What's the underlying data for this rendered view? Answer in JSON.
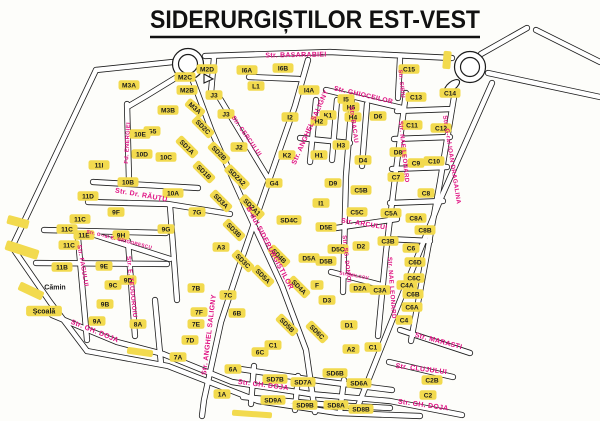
{
  "title": "SIDERURGIȘTILOR EST-VEST",
  "map": {
    "colors": {
      "background": "#fdfdfa",
      "road_line": "#1c1c1c",
      "road_fill": "#ffffff",
      "block_fill": "#f2da4e",
      "block_text": "#1a1a1a",
      "street_text": "#e01283"
    },
    "blocks": [
      {
        "label": "M3A",
        "x": 129,
        "y": 85
      },
      {
        "label": "M2D",
        "x": 207,
        "y": 69
      },
      {
        "label": "M2C",
        "x": 185,
        "y": 77
      },
      {
        "label": "M2B",
        "x": 187,
        "y": 90
      },
      {
        "label": "M3A",
        "x": 195,
        "y": 108,
        "rot": 40
      },
      {
        "label": "M3B",
        "x": 168,
        "y": 110
      },
      {
        "label": "J3",
        "x": 214,
        "y": 95
      },
      {
        "label": "J3",
        "x": 226,
        "y": 114
      },
      {
        "label": "G5",
        "x": 152,
        "y": 131
      },
      {
        "label": "10E",
        "x": 140,
        "y": 134
      },
      {
        "label": "10D",
        "x": 142,
        "y": 154
      },
      {
        "label": "10C",
        "x": 166,
        "y": 157
      },
      {
        "label": "11I",
        "x": 99,
        "y": 165
      },
      {
        "label": "10B",
        "x": 128,
        "y": 182
      },
      {
        "label": "10A",
        "x": 173,
        "y": 193
      },
      {
        "label": "11D",
        "x": 88,
        "y": 196
      },
      {
        "label": "9F",
        "x": 116,
        "y": 212
      },
      {
        "label": "7G",
        "x": 197,
        "y": 212
      },
      {
        "label": "11C",
        "x": 80,
        "y": 219
      },
      {
        "label": "11C",
        "x": 67,
        "y": 229
      },
      {
        "label": "11E",
        "x": 84,
        "y": 235
      },
      {
        "label": "9H",
        "x": 121,
        "y": 235
      },
      {
        "label": "9G",
        "x": 166,
        "y": 229
      },
      {
        "label": "11C",
        "x": 69,
        "y": 245
      },
      {
        "label": "11B",
        "x": 62,
        "y": 267
      },
      {
        "label": "9E",
        "x": 104,
        "y": 266
      },
      {
        "label": "9D",
        "x": 128,
        "y": 280
      },
      {
        "label": "9C",
        "x": 113,
        "y": 285
      },
      {
        "label": "9B",
        "x": 105,
        "y": 304
      },
      {
        "label": "9A",
        "x": 97,
        "y": 321
      },
      {
        "label": "8A",
        "x": 138,
        "y": 324
      },
      {
        "label": "I6A",
        "x": 247,
        "y": 70
      },
      {
        "label": "I6B",
        "x": 283,
        "y": 68
      },
      {
        "label": "L1",
        "x": 256,
        "y": 86
      },
      {
        "label": "I4A",
        "x": 309,
        "y": 90
      },
      {
        "label": "K1",
        "x": 328,
        "y": 115
      },
      {
        "label": "I2",
        "x": 290,
        "y": 117
      },
      {
        "label": "I5",
        "x": 346,
        "y": 99
      },
      {
        "label": "H6",
        "x": 351,
        "y": 107
      },
      {
        "label": "H2",
        "x": 319,
        "y": 121
      },
      {
        "label": "H4",
        "x": 353,
        "y": 117
      },
      {
        "label": "H3",
        "x": 341,
        "y": 145
      },
      {
        "label": "H1",
        "x": 319,
        "y": 155
      },
      {
        "label": "K2",
        "x": 287,
        "y": 155
      },
      {
        "label": "J2",
        "x": 239,
        "y": 147
      },
      {
        "label": "D6",
        "x": 378,
        "y": 116
      },
      {
        "label": "D4",
        "x": 363,
        "y": 160
      },
      {
        "label": "SD2C",
        "x": 203,
        "y": 127,
        "rot": 45
      },
      {
        "label": "SD1A",
        "x": 187,
        "y": 147,
        "rot": 45
      },
      {
        "label": "SD2B",
        "x": 219,
        "y": 153,
        "rot": 45
      },
      {
        "label": "SD1B",
        "x": 204,
        "y": 172,
        "rot": 45
      },
      {
        "label": "SD2A2",
        "x": 237,
        "y": 177,
        "rot": 45
      },
      {
        "label": "SD3A",
        "x": 221,
        "y": 201,
        "rot": 45
      },
      {
        "label": "SD2A1",
        "x": 252,
        "y": 207,
        "rot": 45
      },
      {
        "label": "SD3B",
        "x": 234,
        "y": 230,
        "rot": 45
      },
      {
        "label": "SD3C",
        "x": 243,
        "y": 261,
        "rot": 45
      },
      {
        "label": "SD4B",
        "x": 279,
        "y": 256,
        "rot": 45
      },
      {
        "label": "SD4C",
        "x": 289,
        "y": 220
      },
      {
        "label": "SD5A",
        "x": 263,
        "y": 276,
        "rot": 45
      },
      {
        "label": "SD4A",
        "x": 299,
        "y": 287,
        "rot": 45
      },
      {
        "label": "SD5B",
        "x": 287,
        "y": 325,
        "rot": 45
      },
      {
        "label": "SD6C",
        "x": 317,
        "y": 332,
        "rot": 45
      },
      {
        "label": "G4",
        "x": 274,
        "y": 183
      },
      {
        "label": "A3",
        "x": 221,
        "y": 247
      },
      {
        "label": "I1",
        "x": 321,
        "y": 203
      },
      {
        "label": "D9",
        "x": 333,
        "y": 183
      },
      {
        "label": "D5E",
        "x": 326,
        "y": 227
      },
      {
        "label": "D5C",
        "x": 338,
        "y": 249
      },
      {
        "label": "D5A",
        "x": 309,
        "y": 258
      },
      {
        "label": "D5B",
        "x": 326,
        "y": 261
      },
      {
        "label": "D2",
        "x": 361,
        "y": 246
      },
      {
        "label": "D2A",
        "x": 360,
        "y": 288
      },
      {
        "label": "C3A",
        "x": 380,
        "y": 290
      },
      {
        "label": "C3B",
        "x": 388,
        "y": 241
      },
      {
        "label": "D1",
        "x": 349,
        "y": 325
      },
      {
        "label": "A2",
        "x": 351,
        "y": 349
      },
      {
        "label": "C1",
        "x": 373,
        "y": 347
      },
      {
        "label": "F",
        "x": 317,
        "y": 285
      },
      {
        "label": "D3",
        "x": 327,
        "y": 300
      },
      {
        "label": "C15",
        "x": 409,
        "y": 69
      },
      {
        "label": "C13",
        "x": 416,
        "y": 97
      },
      {
        "label": "C14",
        "x": 450,
        "y": 93
      },
      {
        "label": "C11",
        "x": 412,
        "y": 125
      },
      {
        "label": "C12",
        "x": 441,
        "y": 128
      },
      {
        "label": "D8",
        "x": 398,
        "y": 152
      },
      {
        "label": "C9",
        "x": 416,
        "y": 163
      },
      {
        "label": "C10",
        "x": 434,
        "y": 161
      },
      {
        "label": "C7",
        "x": 396,
        "y": 177
      },
      {
        "label": "C8",
        "x": 426,
        "y": 193
      },
      {
        "label": "C5B",
        "x": 361,
        "y": 190
      },
      {
        "label": "C5C",
        "x": 357,
        "y": 212
      },
      {
        "label": "C5A",
        "x": 391,
        "y": 213
      },
      {
        "label": "C8A",
        "x": 416,
        "y": 218
      },
      {
        "label": "C8B",
        "x": 425,
        "y": 230
      },
      {
        "label": "C6",
        "x": 411,
        "y": 248
      },
      {
        "label": "C6D",
        "x": 415,
        "y": 262
      },
      {
        "label": "C6C",
        "x": 414,
        "y": 278
      },
      {
        "label": "C4A",
        "x": 407,
        "y": 285
      },
      {
        "label": "C6B",
        "x": 413,
        "y": 294
      },
      {
        "label": "C6A",
        "x": 412,
        "y": 307
      },
      {
        "label": "C4",
        "x": 404,
        "y": 320
      },
      {
        "label": "7B",
        "x": 196,
        "y": 288
      },
      {
        "label": "7C",
        "x": 228,
        "y": 295
      },
      {
        "label": "7F",
        "x": 199,
        "y": 312
      },
      {
        "label": "7E",
        "x": 196,
        "y": 324
      },
      {
        "label": "7D",
        "x": 190,
        "y": 340
      },
      {
        "label": "7A",
        "x": 178,
        "y": 357
      },
      {
        "label": "6B",
        "x": 237,
        "y": 313
      },
      {
        "label": "C1",
        "x": 273,
        "y": 345
      },
      {
        "label": "6C",
        "x": 260,
        "y": 352
      },
      {
        "label": "6A",
        "x": 233,
        "y": 369
      },
      {
        "label": "1A",
        "x": 222,
        "y": 394
      },
      {
        "label": "SD7B",
        "x": 275,
        "y": 379
      },
      {
        "label": "SD7A",
        "x": 303,
        "y": 382
      },
      {
        "label": "SD9A",
        "x": 273,
        "y": 400
      },
      {
        "label": "SD9B",
        "x": 305,
        "y": 405
      },
      {
        "label": "SD6B",
        "x": 335,
        "y": 373
      },
      {
        "label": "SD6A",
        "x": 359,
        "y": 383
      },
      {
        "label": "SD8A",
        "x": 336,
        "y": 405
      },
      {
        "label": "SD8B",
        "x": 361,
        "y": 409
      },
      {
        "label": "C2B",
        "x": 432,
        "y": 380
      },
      {
        "label": "C2",
        "x": 428,
        "y": 395
      }
    ],
    "streets": [
      {
        "name": "Str. BASARABIEI",
        "x": 296,
        "y": 57,
        "rot": -1,
        "fs": 7
      },
      {
        "name": "Fd. ENERGIEI",
        "x": 129,
        "y": 143,
        "rot": -87,
        "fs": 5.8
      },
      {
        "name": "Str. CERCULUI",
        "x": 245,
        "y": 137,
        "rot": 55,
        "fs": 6.2
      },
      {
        "name": "Str. ANGHEL SALIGNY",
        "x": 312,
        "y": 128,
        "rot": -66,
        "fs": 7
      },
      {
        "name": "Str. ANGHEL SALIGNY",
        "x": 211,
        "y": 335,
        "rot": -83,
        "fs": 7
      },
      {
        "name": "Str. GHIOCEILOR",
        "x": 363,
        "y": 97,
        "rot": 13,
        "fs": 6.8
      },
      {
        "name": "Str. BACAU",
        "x": 352,
        "y": 125,
        "rot": 82,
        "fs": 6.2
      },
      {
        "name": "Str. NAE LEONARD",
        "x": 402,
        "y": 152,
        "rot": 84,
        "fs": 6.2
      },
      {
        "name": "Str. NAE LEONARD",
        "x": 390,
        "y": 288,
        "rot": 86,
        "fs": 6.2
      },
      {
        "name": "Str. G-ral IOAN DRAGALINA",
        "x": 450,
        "y": 160,
        "rot": 81,
        "fs": 6.2
      },
      {
        "name": "Str. SIBIU",
        "x": 400,
        "y": 84,
        "rot": 84,
        "fs": 5.6
      },
      {
        "name": "Str. ARCULUI",
        "x": 364,
        "y": 226,
        "rot": 9,
        "fs": 6.8
      },
      {
        "name": "Str. SG. DONICI",
        "x": 345,
        "y": 259,
        "rot": 84,
        "fs": 5.8
      },
      {
        "name": "Str. MILCOV",
        "x": 354,
        "y": 277,
        "rot": 10,
        "fs": 4.6
      },
      {
        "name": "B-dul SIDERURGIȘTILOR",
        "x": 268,
        "y": 249,
        "rot": 62,
        "fs": 7.2
      },
      {
        "name": "Str. Dr. RĂUȚU",
        "x": 141,
        "y": 197,
        "rot": 10,
        "fs": 7
      },
      {
        "name": "Str. FAGULUI",
        "x": 81,
        "y": 266,
        "rot": 80,
        "fs": 6.2
      },
      {
        "name": "Str. E. TEODOROIU",
        "x": 130,
        "y": 287,
        "rot": 84,
        "fs": 6.2
      },
      {
        "name": "Str. G-ral E. GRIGORESCU",
        "x": 119,
        "y": 241,
        "rot": 14,
        "fs": 4.8
      },
      {
        "name": "Str. GH. DOJA",
        "x": 94,
        "y": 333,
        "rot": 22,
        "fs": 7
      },
      {
        "name": "Str. GH. DOJA",
        "x": 263,
        "y": 387,
        "rot": 7,
        "fs": 7
      },
      {
        "name": "Str. GH. DOJA",
        "x": 423,
        "y": 407,
        "rot": 8,
        "fs": 7
      },
      {
        "name": "Str. MARASTI",
        "x": 438,
        "y": 343,
        "rot": 15,
        "fs": 7
      },
      {
        "name": "Str. CLUJULUI",
        "x": 421,
        "y": 371,
        "rot": 7,
        "fs": 7
      }
    ],
    "places": [
      {
        "label": "Cămin",
        "x": 55,
        "y": 287,
        "bg": false
      },
      {
        "label": "Școală",
        "x": 44,
        "y": 311,
        "bg": true
      }
    ]
  }
}
